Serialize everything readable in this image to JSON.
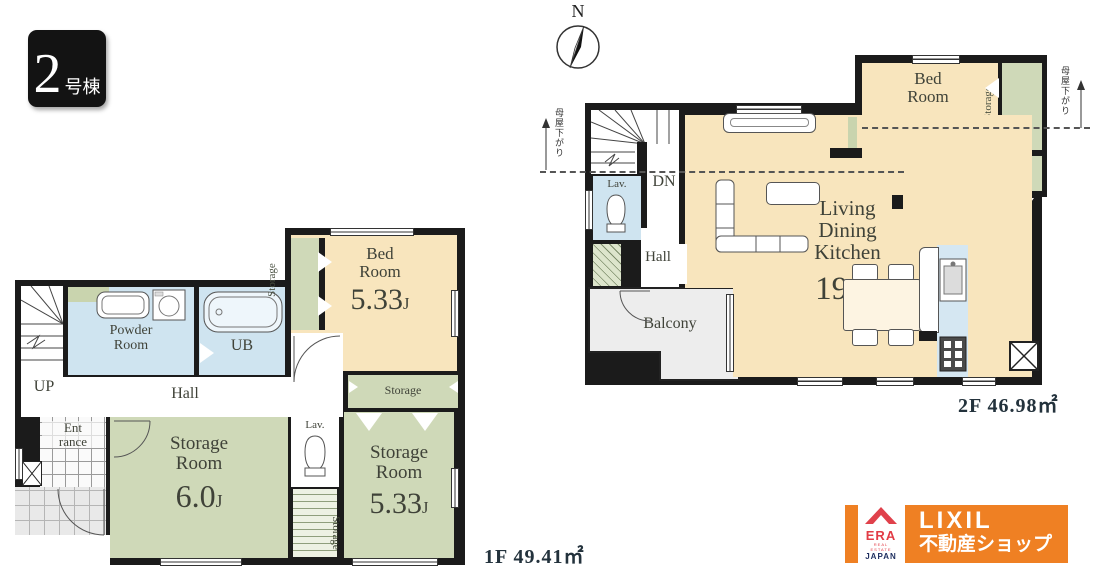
{
  "badge": {
    "number": "2",
    "label": "号棟"
  },
  "compass": {
    "north": "N"
  },
  "floor1": {
    "area": "1F 49.41㎡",
    "labels": {
      "up": "UP",
      "hall": "Hall",
      "ub": "UB",
      "lav": "Lav.",
      "powder_line1": "Powder",
      "powder_line2": "Room",
      "entrance_line1": "Ent",
      "entrance_line2": "rance",
      "bed_line1": "Bed",
      "bed_line2": "Room",
      "bed_value": "5.33",
      "bed_unit": "J",
      "storage_a_line1": "Storage",
      "storage_a_line2": "Room",
      "storage_a_value": "6.0",
      "storage_a_unit": "J",
      "storage_b_line1": "Storage",
      "storage_b_line2": "Room",
      "storage_b_value": "5.33",
      "storage_b_unit": "J",
      "closet_bed": "Storage",
      "closet_hatch": "Storage",
      "closet_top": "Storage"
    }
  },
  "floor2": {
    "area": "2F 46.98㎡",
    "labels": {
      "dn": "DN",
      "hall": "Hall",
      "lav": "Lav.",
      "balcony": "Balcony",
      "sto": "Sto.",
      "ldk_line1": "Living",
      "ldk_line2": "Dining",
      "ldk_line3": "Kitchen",
      "ldk_value": "19.0",
      "ldk_unit": "J",
      "bed_line1": "Bed",
      "bed_line2": "Room",
      "bed_value": "4.5",
      "bed_unit": "J",
      "closet": "Storage",
      "roof_note_left": "母屋下がり",
      "roof_note_right": "母屋下がり"
    }
  },
  "logo": {
    "era": "ERA",
    "era_tagline": "REAL ESTATE",
    "era_country": "JAPAN",
    "brand": "LIXIL",
    "brand_sub": "不動産ショップ"
  },
  "colors": {
    "wall": "#1b1b1b",
    "room_cream": "#f8e5bd",
    "room_green": "#cfd9b8",
    "room_blue": "#cfe4f0",
    "balcony_gray": "#ededed",
    "brand_orange": "#ef8023",
    "era_red": "#e0414b",
    "era_navy": "#1d2d5e"
  }
}
